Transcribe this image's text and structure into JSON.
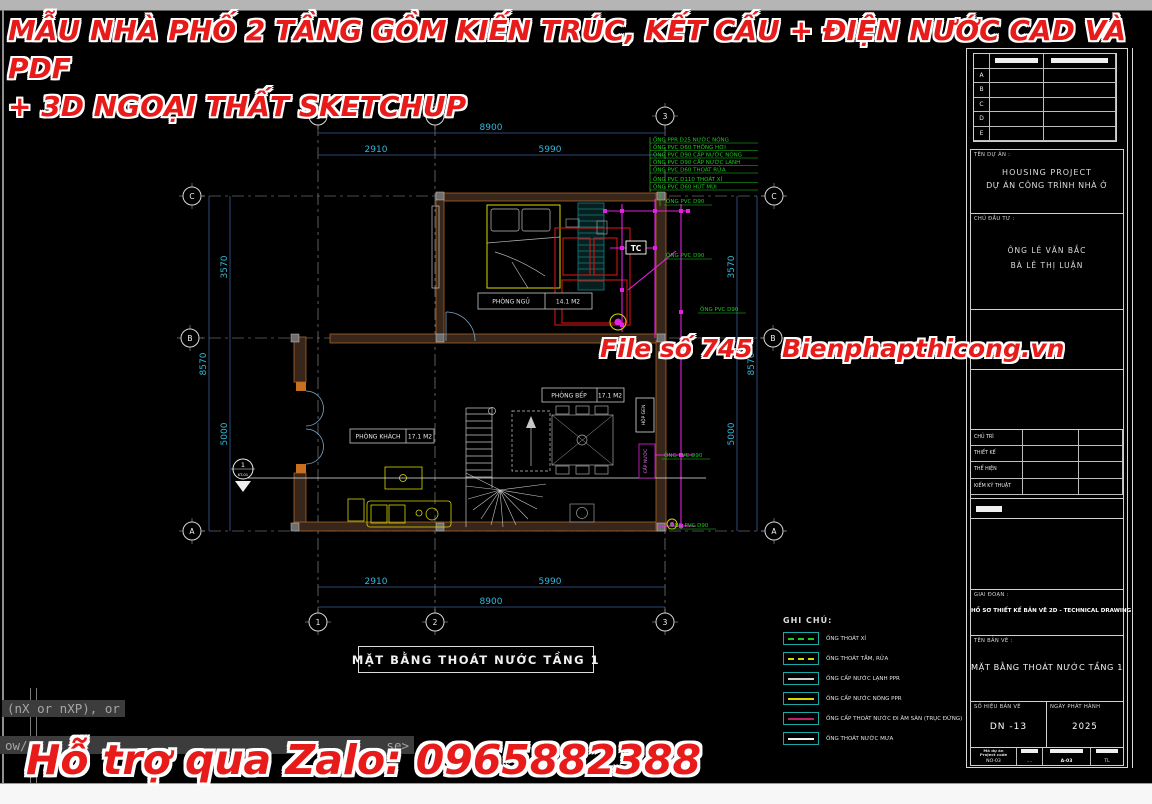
{
  "watermark": {
    "accent_color": "#e81b1b",
    "title_line1": "MẪU NHÀ PHỐ 2 TẦNG GỒM KIẾN TRÚC, KẾT CẤU + ĐIỆN NƯỚC CAD VÀ PDF",
    "title_line2": "+ 3D NGOẠI THẤT SKETCHUP",
    "file_no": "File số 745",
    "website": "Bienphapthicong.vn",
    "zalo": "Hỗ trợ qua Zalo: 0965882388"
  },
  "command_line": {
    "line1": "(nX or nXP), or",
    "line2": "ow/",
    "line2_end": "se>"
  },
  "plan": {
    "title": "MẶT BẰNG THOÁT NƯỚC TẦNG 1",
    "grid_cols": [
      "1",
      "2",
      "3"
    ],
    "grid_rows": [
      "C",
      "B",
      "A"
    ],
    "dims": {
      "top_total": "8900",
      "top_seg1": "2910",
      "top_seg2": "5990",
      "bottom_seg1": "2910",
      "bottom_seg2": "5990",
      "bottom_total": "8900",
      "left_seg1": "3570",
      "left_seg2": "5000",
      "left_total": "8570",
      "right_seg1": "3570",
      "right_seg2": "5000",
      "right_total": "8570"
    },
    "rooms": [
      {
        "name": "PHÒNG NGỦ",
        "area": "14.1 M2"
      },
      {
        "name": "PHÒNG BẾP",
        "area": "17.1 M2"
      },
      {
        "name": "PHÒNG KHÁCH",
        "area": "17.1 M2"
      }
    ],
    "pipe_notes": [
      "ỐNG PPR D25 NƯỚC NÓNG",
      "ỐNG PVC D60 THÔNG HƠI",
      "ỐNG PVC D90 CẤP NƯỚC NÓNG",
      "ỐNG PVC D90 CẤP NƯỚC LẠNH",
      "ỐNG PVC D60 THOÁT RỬA",
      "ỐNG PVC D110 THOÁT XÍ",
      "ỐNG PVC D60 HÚT MÙI"
    ],
    "pipe_labels": [
      "ỐNG PVC D90",
      "ỐNG PVC D90",
      "ỐNG PVC D90",
      "ỐNG PVC D90",
      "ỐNG PVC D90"
    ],
    "tc_label": "TC",
    "shaft_label": "HỘP GEN",
    "supply_label": "CẤP NƯỚC",
    "section_marker": {
      "number": "1",
      "sheet": "KT-01"
    },
    "legend": {
      "title": "GHI CHÚ:",
      "items": [
        {
          "label": "ỐNG THOÁT XÍ",
          "color": "#1ecb1e",
          "style": "dashed"
        },
        {
          "label": "ỐNG THOÁT TẮM, RỬA",
          "color": "#d8d800",
          "style": "dashed"
        },
        {
          "label": "ỐNG CẤP NƯỚC LẠNH PPR",
          "color": "#cfcfcf",
          "style": "solid"
        },
        {
          "label": "ỐNG CẤP NƯỚC NÓNG PPR",
          "color": "#d8d800",
          "style": "solid"
        },
        {
          "label": "ỐNG CẤP THOÁT NƯỚC ĐI ÂM SÀN (TRỤC ĐỨNG)",
          "color": "#c02070",
          "style": "solid"
        },
        {
          "label": "ỐNG THOÁT NƯỚC MƯA",
          "color": "#f0f0f0",
          "style": "solid"
        }
      ]
    }
  },
  "titleblock": {
    "revision_rows": [
      "A",
      "B",
      "C",
      "D",
      "E"
    ],
    "project_label": "TÊN DỰ ÁN :",
    "project_name_en": "HOUSING PROJECT",
    "project_name_vi": "DỰ ÁN CÔNG TRÌNH NHÀ Ở",
    "owner_label": "CHỦ ĐẦU TƯ :",
    "owner_1": "ÔNG LÊ VĂN BẮC",
    "owner_2": "BÀ LÊ THỊ LUẬN",
    "sig_rows": [
      "CHỦ TRÌ",
      "THIẾT KẾ",
      "THỂ HIỆN",
      "KIỂM KỸ THUẬT"
    ],
    "phase_label": "GIAI ĐOẠN :",
    "phase_value": "HỒ SƠ THIẾT KẾ BẢN VẼ 2D - TECHNICAL DRAWING",
    "sheet_label": "TÊN BẢN VẼ :",
    "sheet_value": "MẶT BẰNG THOÁT NƯỚC TẦNG 1",
    "number_label": "SỐ HIỆU BẢN VẼ",
    "number_value": "DN -13",
    "issue_label": "NGÀY PHÁT HÀNH",
    "issue_value": "2025",
    "code_label_1": "Mã dự án",
    "code_label_2": "Project code",
    "code_value": "NO-03",
    "col2_value": "....",
    "col3_value": "A-03",
    "col4_value": "TL"
  }
}
